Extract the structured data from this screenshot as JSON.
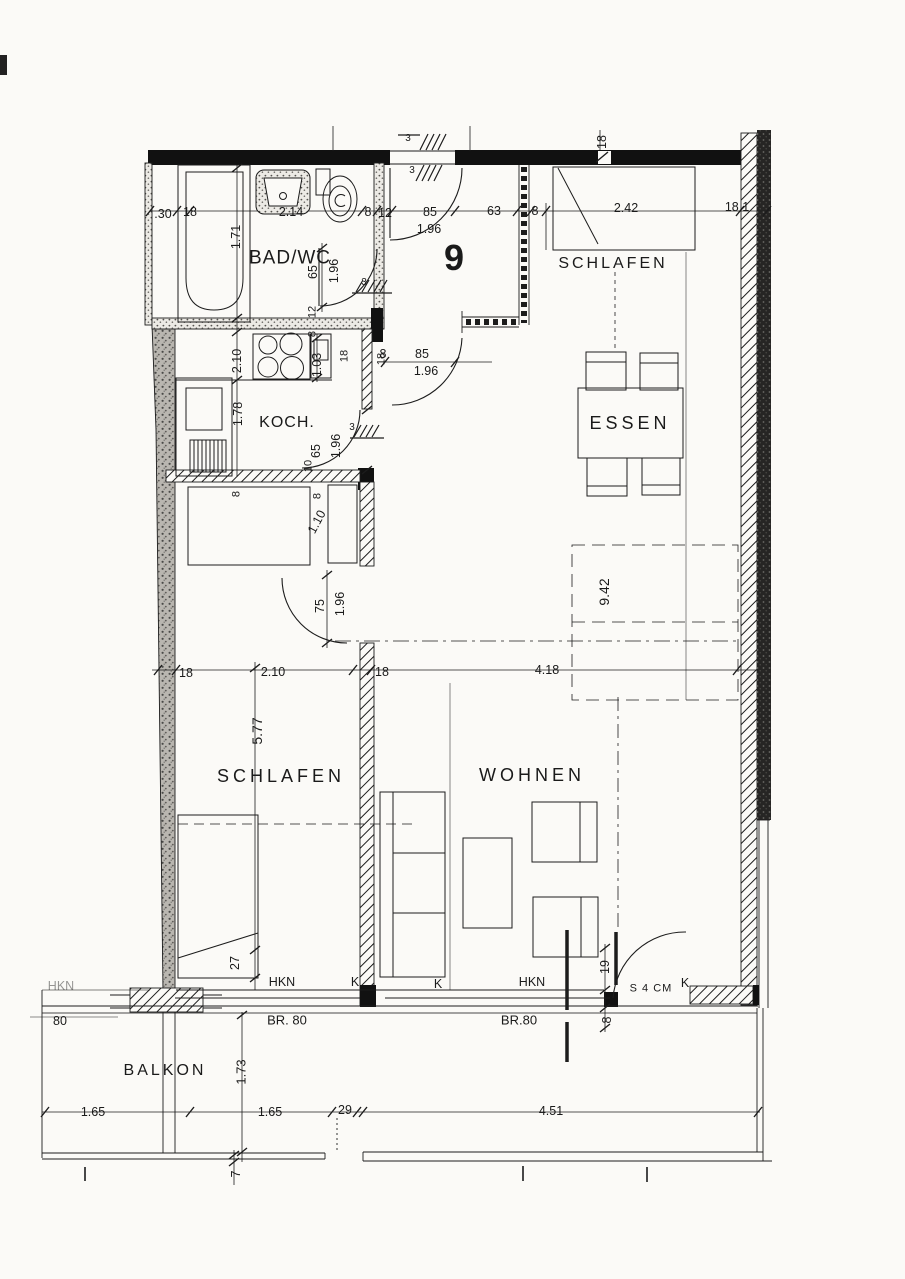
{
  "document": {
    "type": "floor-plan",
    "unit_number": "9",
    "rooms": [
      "BAD/WC",
      "SCHLAFEN",
      "KOCH.",
      "ESSEN",
      "WOHNEN",
      "SCHLAFEN",
      "BALKON"
    ],
    "ink_color": "#1c1c1c",
    "paper_color": "#fbfaf7"
  },
  "labels": [
    {
      "name": "room-label-bad-wc",
      "text": "BAD/WC",
      "x": 290,
      "y": 258,
      "size": 19,
      "ls": 1
    },
    {
      "name": "room-label-schlafen-top",
      "text": "SCHLAFEN",
      "x": 613,
      "y": 264,
      "size": 16,
      "ls": 3
    },
    {
      "name": "room-label-koch",
      "text": "KOCH.",
      "x": 287,
      "y": 423,
      "size": 16,
      "ls": 1
    },
    {
      "name": "room-label-essen",
      "text": "ESSEN",
      "x": 630,
      "y": 423,
      "size": 18,
      "ls": 4
    },
    {
      "name": "room-label-schlafen",
      "text": "SCHLAFEN",
      "x": 281,
      "y": 776,
      "size": 18,
      "ls": 4
    },
    {
      "name": "room-label-wohnen",
      "text": "WOHNEN",
      "x": 532,
      "y": 775,
      "size": 18,
      "ls": 4
    },
    {
      "name": "room-label-balkon",
      "text": "BALKON",
      "x": 165,
      "y": 1071,
      "size": 16,
      "ls": 3
    },
    {
      "name": "apartment-number",
      "text": "9",
      "x": 454,
      "y": 258,
      "size": 36,
      "bold": true
    },
    {
      "name": "dim-30",
      "text": ".30",
      "x": 163,
      "y": 214
    },
    {
      "name": "dim-18-a",
      "text": "18",
      "x": 190,
      "y": 212
    },
    {
      "name": "dim-214",
      "text": "2.14",
      "x": 291,
      "y": 212
    },
    {
      "name": "dim-8-a",
      "text": "8",
      "x": 368,
      "y": 212
    },
    {
      "name": "dim-12-a",
      "text": "12",
      "x": 385,
      "y": 213
    },
    {
      "name": "dim-85-a",
      "text": "85",
      "x": 430,
      "y": 212
    },
    {
      "name": "dim-196-a",
      "text": "1.96",
      "x": 429,
      "y": 229
    },
    {
      "name": "dim-63",
      "text": "63",
      "x": 494,
      "y": 211
    },
    {
      "name": "dim-8-b",
      "text": "8",
      "x": 535,
      "y": 211
    },
    {
      "name": "dim-242",
      "text": "2.42",
      "x": 626,
      "y": 208
    },
    {
      "name": "dim-181",
      "text": "18.1",
      "x": 737,
      "y": 207
    },
    {
      "name": "dim-18-wall",
      "text": "18",
      "x": 602,
      "y": 142,
      "rot": -90
    },
    {
      "name": "dim-3-a",
      "text": "3",
      "x": 408,
      "y": 139,
      "size": 10
    },
    {
      "name": "dim-3-b",
      "text": "3",
      "x": 412,
      "y": 171,
      "size": 10
    },
    {
      "name": "dim-171",
      "text": "1.71",
      "x": 236,
      "y": 237,
      "rot": -90
    },
    {
      "name": "dim-65-bath",
      "text": "65",
      "x": 313,
      "y": 272,
      "rot": -90
    },
    {
      "name": "dim-196-bath",
      "text": "1.96",
      "x": 334,
      "y": 271,
      "rot": -90
    },
    {
      "name": "dim-12-b",
      "text": "12",
      "x": 313,
      "y": 312,
      "rot": -90,
      "size": 11
    },
    {
      "name": "dim-8-c",
      "text": "8",
      "x": 313,
      "y": 334,
      "rot": -90,
      "size": 11
    },
    {
      "name": "dim-3-c",
      "text": "3",
      "x": 364,
      "y": 283,
      "size": 10
    },
    {
      "name": "dim-210-v",
      "text": "2.10",
      "x": 237,
      "y": 361,
      "rot": -90
    },
    {
      "name": "dim-178",
      "text": "1.78",
      "x": 238,
      "y": 414,
      "rot": -90
    },
    {
      "name": "dim-103",
      "text": "1.03",
      "x": 317,
      "y": 365,
      "rot": -90
    },
    {
      "name": "dim-18-c",
      "text": "18",
      "x": 345,
      "y": 356,
      "rot": -90,
      "size": 11
    },
    {
      "name": "dim-18-d",
      "text": "18",
      "x": 382,
      "y": 359,
      "rot": -90,
      "size": 11
    },
    {
      "name": "dim-65-koch",
      "text": "65",
      "x": 316,
      "y": 451,
      "rot": -90
    },
    {
      "name": "dim-196-koch",
      "text": "1.96",
      "x": 336,
      "y": 446,
      "rot": -90
    },
    {
      "name": "dim-3-d",
      "text": "3",
      "x": 352,
      "y": 428,
      "size": 10
    },
    {
      "name": "dim-10",
      "text": "10",
      "x": 309,
      "y": 466,
      "rot": -90,
      "size": 11
    },
    {
      "name": "dim-8-d",
      "text": "8",
      "x": 383,
      "y": 354
    },
    {
      "name": "dim-85-b",
      "text": "85",
      "x": 422,
      "y": 354
    },
    {
      "name": "dim-196-b",
      "text": "1.96",
      "x": 426,
      "y": 371
    },
    {
      "name": "dim-8-e",
      "text": "8",
      "x": 237,
      "y": 494,
      "rot": -90,
      "size": 11
    },
    {
      "name": "dim-8-f",
      "text": "8",
      "x": 318,
      "y": 496,
      "rot": -90,
      "size": 11
    },
    {
      "name": "dim-110",
      "text": "1.10",
      "x": 317,
      "y": 522,
      "rot": -62
    },
    {
      "name": "dim-75",
      "text": "75",
      "x": 320,
      "y": 606,
      "rot": -90
    },
    {
      "name": "dim-196-c",
      "text": "1.96",
      "x": 340,
      "y": 604,
      "rot": -90
    },
    {
      "name": "dim-18-e",
      "text": "18",
      "x": 186,
      "y": 673
    },
    {
      "name": "dim-210-h",
      "text": "2.10",
      "x": 273,
      "y": 672
    },
    {
      "name": "dim-18-f",
      "text": "18",
      "x": 382,
      "y": 672
    },
    {
      "name": "dim-418",
      "text": "4.18",
      "x": 547,
      "y": 670
    },
    {
      "name": "dim-942",
      "text": "9.42",
      "x": 604,
      "y": 592,
      "rot": -90,
      "size": 14
    },
    {
      "name": "dim-577",
      "text": "5.77",
      "x": 257,
      "y": 731,
      "rot": -90,
      "size": 14
    },
    {
      "name": "dim-27",
      "text": "27",
      "x": 235,
      "y": 963,
      "rot": -90
    },
    {
      "name": "note-hkn-left",
      "text": "HKN",
      "x": 61,
      "y": 986,
      "op": 0.45
    },
    {
      "name": "note-hkn-a",
      "text": "HKN",
      "x": 282,
      "y": 982
    },
    {
      "name": "note-k-a",
      "text": "K",
      "x": 355,
      "y": 982
    },
    {
      "name": "note-k-b",
      "text": "K",
      "x": 438,
      "y": 984
    },
    {
      "name": "note-hkn-b",
      "text": "HKN",
      "x": 532,
      "y": 982
    },
    {
      "name": "note-k-c",
      "text": "K",
      "x": 685,
      "y": 983
    },
    {
      "name": "dim-19",
      "text": "19",
      "x": 605,
      "y": 967,
      "rot": -90
    },
    {
      "name": "note-s4cm",
      "text": "S 4 CM",
      "x": 651,
      "y": 989,
      "size": 11,
      "ls": 1
    },
    {
      "name": "dim-8-g",
      "text": "8",
      "x": 607,
      "y": 1020,
      "rot": -90
    },
    {
      "name": "dim-80",
      "text": "80",
      "x": 60,
      "y": 1021
    },
    {
      "name": "note-br80-a",
      "text": "BR. 80",
      "x": 287,
      "y": 1020,
      "size": 13
    },
    {
      "name": "note-br80-b",
      "text": "BR.80",
      "x": 519,
      "y": 1020,
      "size": 13
    },
    {
      "name": "dim-173",
      "text": "1.73",
      "x": 241,
      "y": 1072,
      "rot": -90,
      "size": 13
    },
    {
      "name": "dim-165-a",
      "text": "1.65",
      "x": 93,
      "y": 1112
    },
    {
      "name": "dim-165-b",
      "text": "1.65",
      "x": 270,
      "y": 1112
    },
    {
      "name": "dim-29",
      "text": "29",
      "x": 345,
      "y": 1110
    },
    {
      "name": "dim-451",
      "text": "4.51",
      "x": 551,
      "y": 1111
    },
    {
      "name": "dim-7",
      "text": "7",
      "x": 236,
      "y": 1174,
      "rot": -90
    }
  ]
}
